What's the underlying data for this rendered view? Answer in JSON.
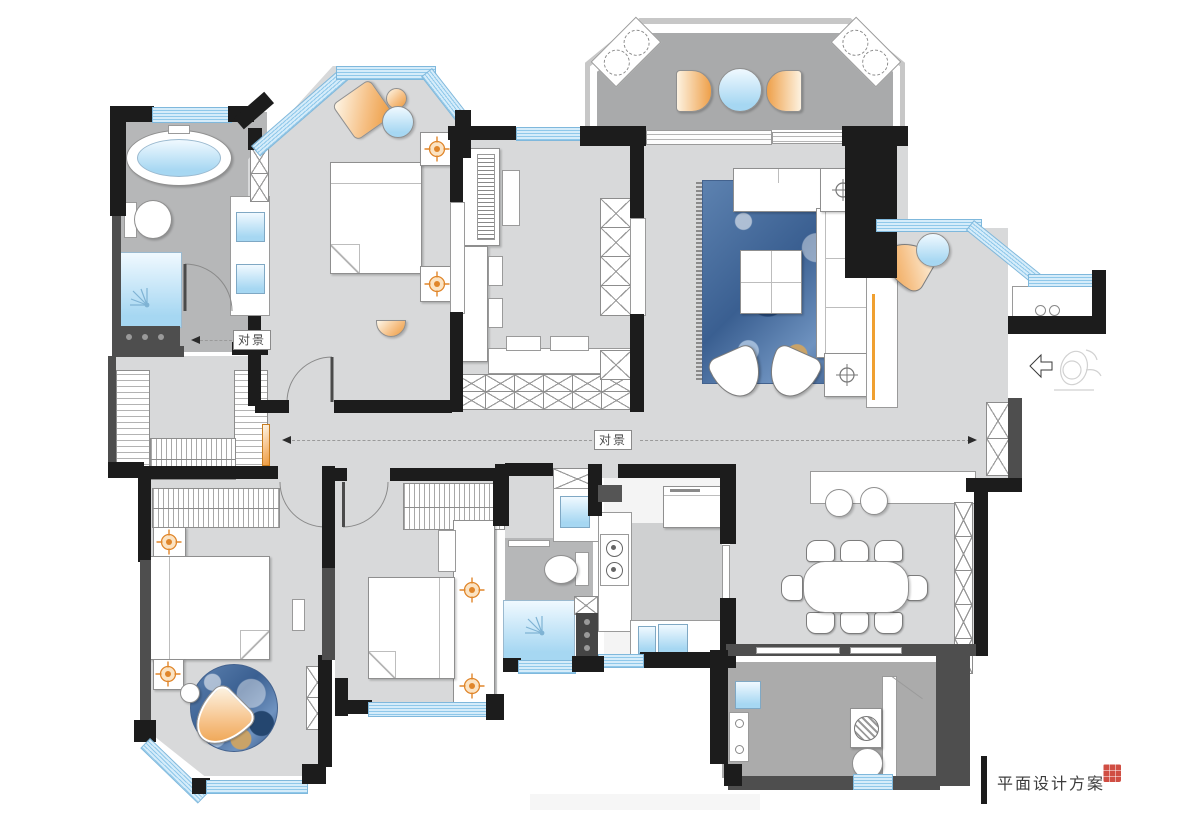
{
  "titleblock": {
    "text": "平面设计方案"
  },
  "annotations": {
    "vista_main": "对景",
    "vista_left": "对景"
  },
  "palette": {
    "background": "#ffffff",
    "wall_black": "#1c1c1c",
    "wall_dark_gray": "#4e4e4e",
    "floor_light_gray": "#d8d9da",
    "floor_mid_gray": "#b6b7b8",
    "balcony_gray": "#a9aaab",
    "window_blue": "#bfe3f6",
    "accent_orange": "#ec9a3e",
    "rug_blue": "#3a5f91",
    "fixture_blue": "#a6d7f2",
    "seal_red": "#cc3b2f"
  }
}
